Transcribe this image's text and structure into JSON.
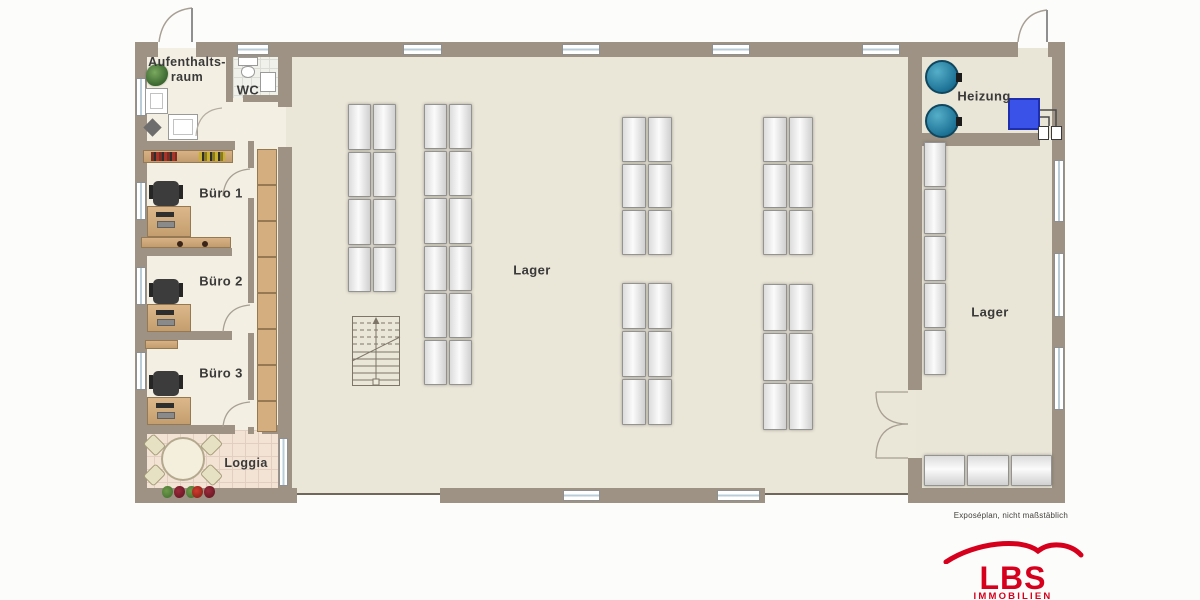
{
  "rooms": {
    "aufenthaltsraum_line1": "Aufenthalts-",
    "aufenthaltsraum_line2": "raum",
    "wc": "WC",
    "buero1": "Büro 1",
    "buero2": "Büro 2",
    "buero3": "Büro 3",
    "loggia": "Loggia",
    "lager_main": "Lager",
    "lager_right": "Lager",
    "heizung": "Heizung"
  },
  "caption": "Exposéplan, nicht maßstäblich",
  "logo": {
    "text": "LBS",
    "subtext": "IMMOBILIEN",
    "brand_red": "#d6001d"
  },
  "colors": {
    "wall": "#9d9284",
    "hall_floor": "#eae6d8",
    "office_floor": "#f3efe2",
    "loggia_floor": "#f3e3d5",
    "wood": "#c9a876",
    "tank_teal": "#2e8fb0",
    "heater_blue": "#3b52e8"
  }
}
